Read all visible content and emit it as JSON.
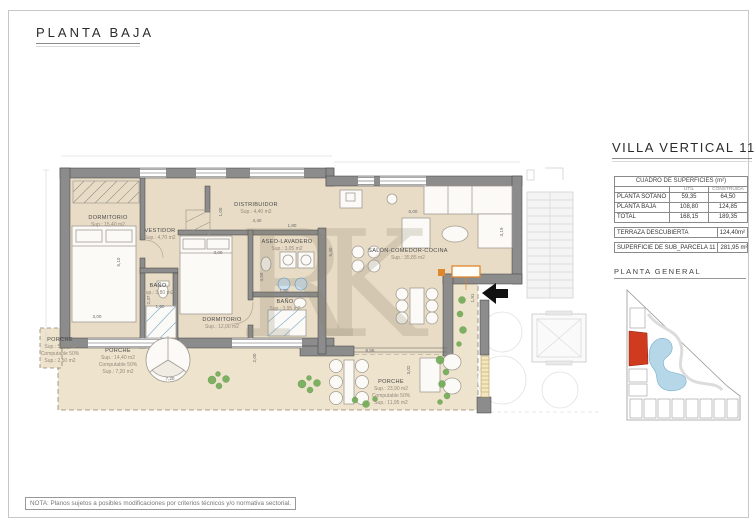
{
  "sheet": {
    "title": "PLANTA BAJA",
    "note": "NOTA: Planos sujetos a posibles modificaciones por criterios técnicos y/o normativa sectorial.",
    "watermark": "RK"
  },
  "panel": {
    "title": "VILLA VERTICAL 11",
    "table": {
      "title": "CUADRO DE SUPERFICIES (m²)",
      "columns": {
        "util": "UTIL",
        "construida": "CONSTRUIDA"
      },
      "rows": [
        {
          "label": "PLANTA SOTANO",
          "util": "59,35",
          "construida": "64,50"
        },
        {
          "label": "PLANTA BAJA",
          "util": "108,80",
          "construida": "124,85"
        },
        {
          "label": "TOTAL",
          "util": "168,15",
          "construida": "189,35"
        }
      ],
      "terraza_label": "TERRAZA DESCUBIERTA",
      "terraza_value": "124,40m²",
      "subparcela_label": "SUPERFICIE DE SUB_PARCELA 11",
      "subparcela_value": "281,95 m²"
    },
    "siteplan_title": "PLANTA GENERAL",
    "colors": {
      "highlight_parcel": "#d03a1e",
      "lagoon": "#b5d7e8",
      "porch_accent": "#e0862c"
    }
  },
  "plan": {
    "rooms": [
      {
        "name": "DORMITORIO",
        "sup": "Sup.: 15,40  m2"
      },
      {
        "name": "VESTIDOR",
        "sup": "Sup.: 4,70  m2"
      },
      {
        "name": "DISTRIBUIDOR",
        "sup": "Sup.: 4,40  m2"
      },
      {
        "name": "ASEO-LAVADERO",
        "sup": "Sup.: 3,05  m2"
      },
      {
        "name": "BAÑO",
        "sup": "Sup.: 3,80  m2"
      },
      {
        "name": "DORMITORIO",
        "sup": "Sup.: 12,00  m2"
      },
      {
        "name": "BAÑO",
        "sup": "Sup.: 3,95  m2"
      },
      {
        "name": "SALÓN-COMEDOR-COCINA",
        "sup": "Sup.: 35,85  m2"
      },
      {
        "name": "PORCHE",
        "sup": "Sup.: 5,00  m2",
        "computable": "Computable 50%",
        "sup50": "Sup.: 2,50  m2"
      },
      {
        "name": "PORCHE",
        "sup": "Sup.: 14,40  m2",
        "computable": "Computable 50%",
        "sup50": "Sup.: 7,20  m2"
      },
      {
        "name": "PORCHE",
        "sup": "Sup.: 23,90  m2",
        "computable": "Computable 50%",
        "sup50": "Sup.: 11,95  m2"
      }
    ],
    "dims": [
      "5,10",
      "3,00",
      "7,20",
      "2,00",
      "8,55",
      "3,02",
      "1,91",
      "3,19",
      "5,40",
      "6,00",
      "4,40",
      "1,00",
      "1,80",
      "4,50",
      "3,00",
      "2,37",
      "1,60",
      "1,80"
    ]
  }
}
